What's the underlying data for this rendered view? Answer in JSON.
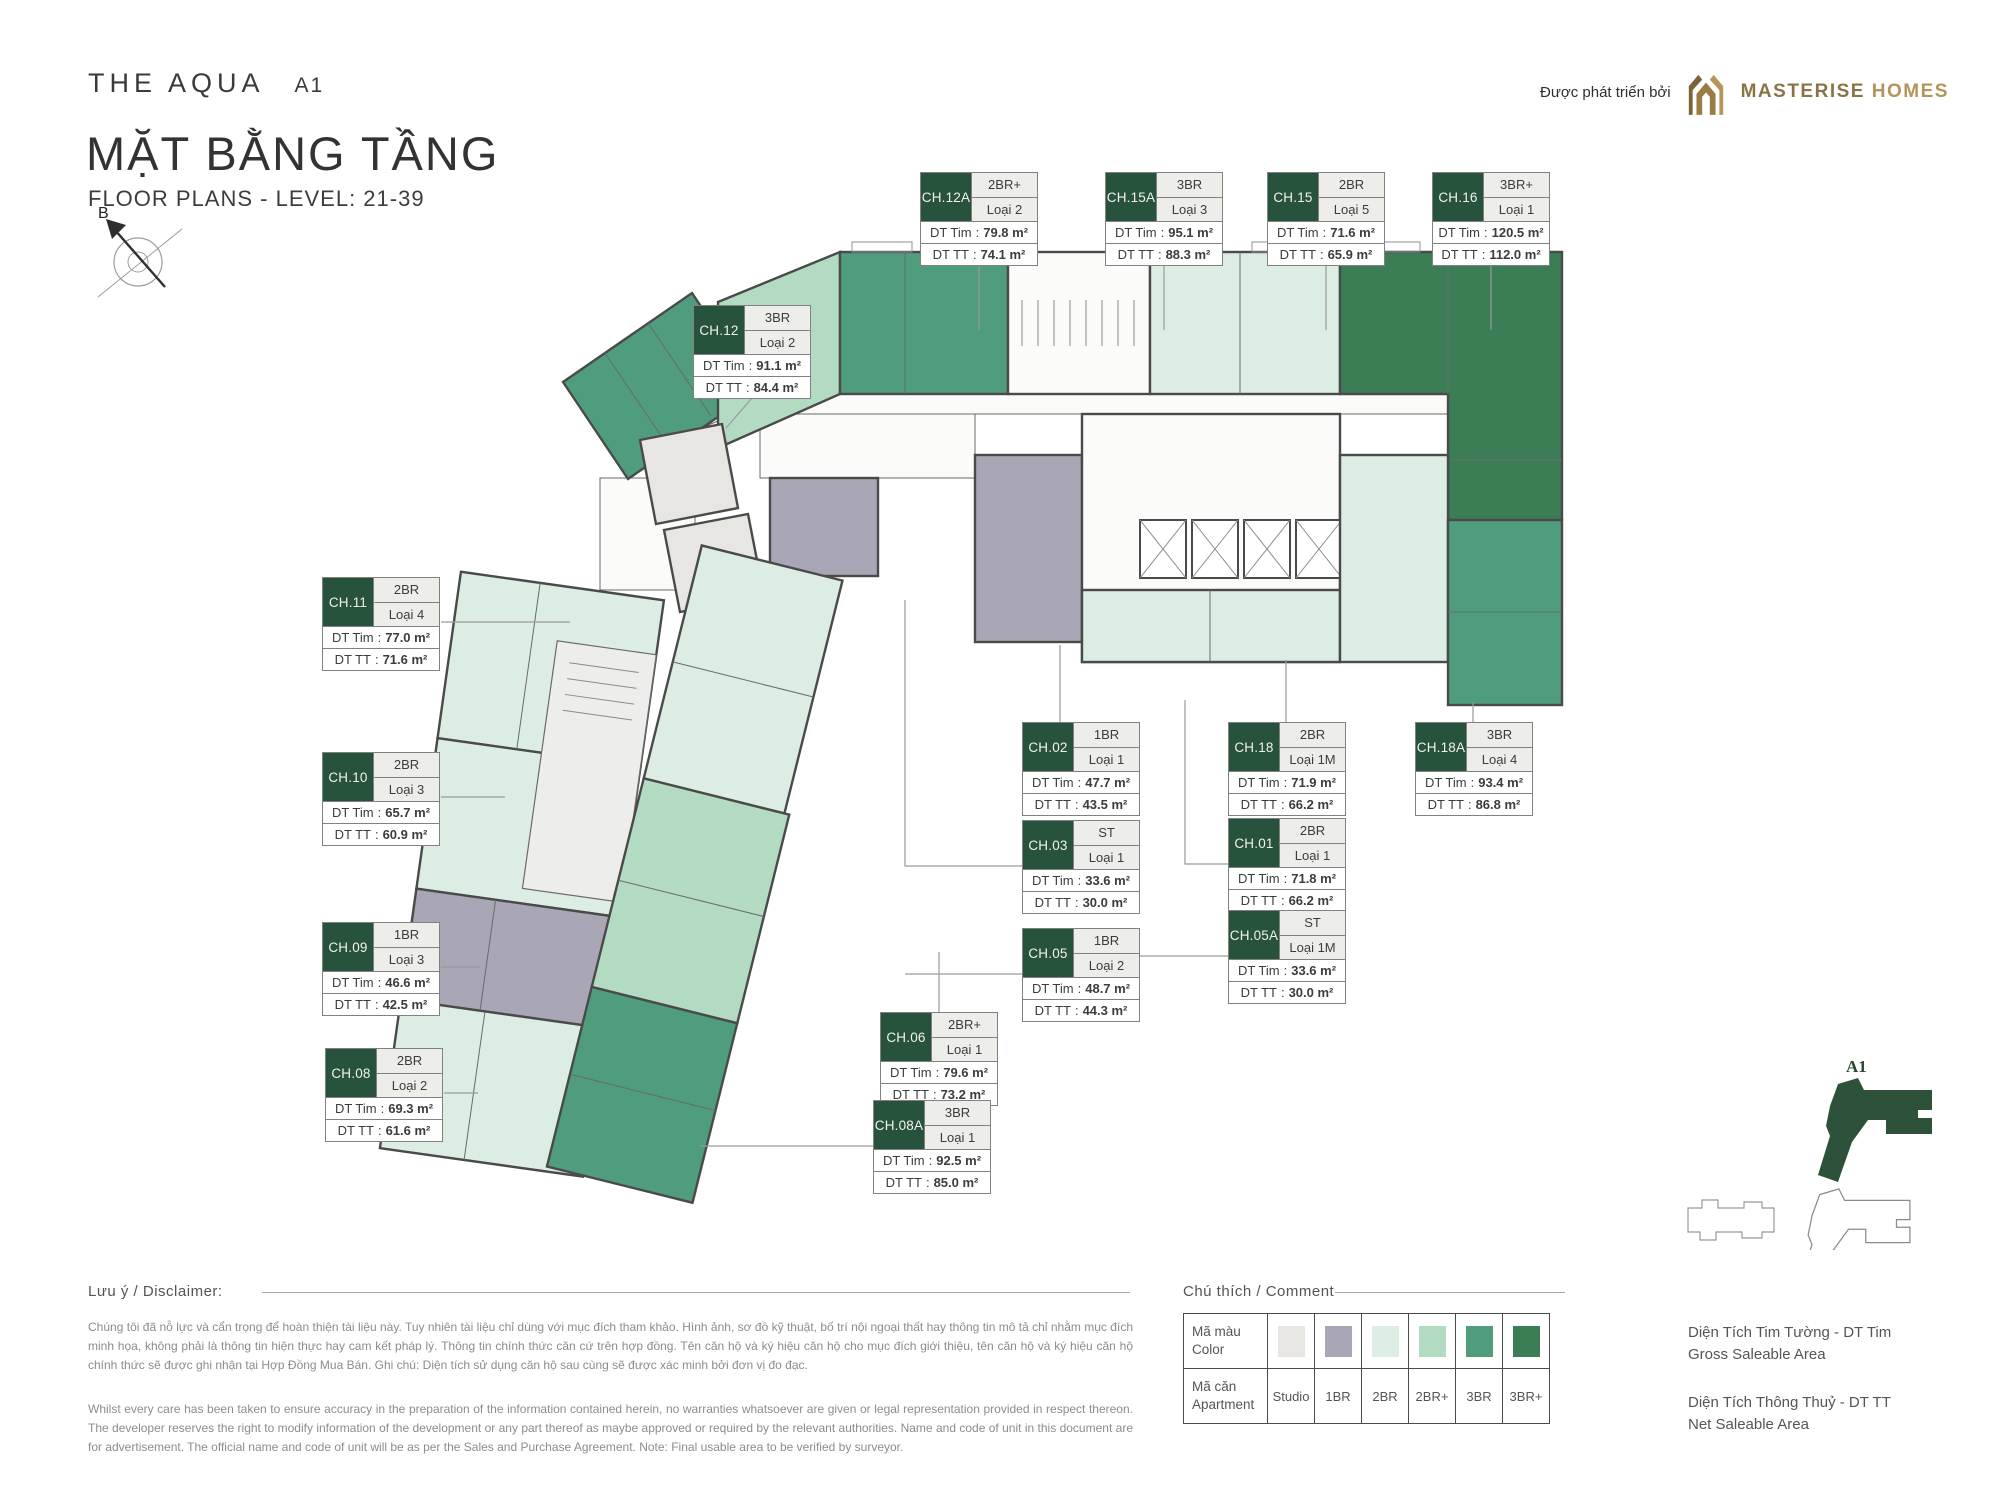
{
  "header": {
    "project": "THE AQUA",
    "tower": "A1",
    "title_vn": "MẶT BẰNG TẦNG",
    "title_en": "FLOOR PLANS - LEVEL: 21-39",
    "developer_prefix": "Được phát triển bởi",
    "developer_name_1": "MASTERISE",
    "developer_name_2": "HOMES",
    "compass_label": "B"
  },
  "labels": {
    "dt_tim": "DT Tim",
    "dt_tt": "DT TT",
    "sep": ":"
  },
  "units": [
    {
      "id": "CH.12A",
      "type": "2BR+",
      "variant": "Loại 2",
      "dt_tim": "79.8 m²",
      "dt_tt": "74.1 m²"
    },
    {
      "id": "CH.15A",
      "type": "3BR",
      "variant": "Loại 3",
      "dt_tim": "95.1 m²",
      "dt_tt": "88.3 m²"
    },
    {
      "id": "CH.15",
      "type": "2BR",
      "variant": "Loại 5",
      "dt_tim": "71.6 m²",
      "dt_tt": "65.9 m²"
    },
    {
      "id": "CH.16",
      "type": "3BR+",
      "variant": "Loại 1",
      "dt_tim": "120.5 m²",
      "dt_tt": "112.0 m²"
    },
    {
      "id": "CH.12",
      "type": "3BR",
      "variant": "Loại 2",
      "dt_tim": "91.1 m²",
      "dt_tt": "84.4 m²"
    },
    {
      "id": "CH.11",
      "type": "2BR",
      "variant": "Loại 4",
      "dt_tim": "77.0 m²",
      "dt_tt": "71.6 m²"
    },
    {
      "id": "CH.10",
      "type": "2BR",
      "variant": "Loại 3",
      "dt_tim": "65.7 m²",
      "dt_tt": "60.9 m²"
    },
    {
      "id": "CH.09",
      "type": "1BR",
      "variant": "Loại 3",
      "dt_tim": "46.6 m²",
      "dt_tt": "42.5 m²"
    },
    {
      "id": "CH.08",
      "type": "2BR",
      "variant": "Loại 2",
      "dt_tim": "69.3 m²",
      "dt_tt": "61.6 m²"
    },
    {
      "id": "CH.02",
      "type": "1BR",
      "variant": "Loại 1",
      "dt_tim": "47.7 m²",
      "dt_tt": "43.5 m²"
    },
    {
      "id": "CH.18",
      "type": "2BR",
      "variant": "Loại 1M",
      "dt_tim": "71.9 m²",
      "dt_tt": "66.2 m²"
    },
    {
      "id": "CH.18A",
      "type": "3BR",
      "variant": "Loại 4",
      "dt_tim": "93.4 m²",
      "dt_tt": "86.8 m²"
    },
    {
      "id": "CH.03",
      "type": "ST",
      "variant": "Loại 1",
      "dt_tim": "33.6 m²",
      "dt_tt": "30.0 m²"
    },
    {
      "id": "CH.01",
      "type": "2BR",
      "variant": "Loại 1",
      "dt_tim": "71.8 m²",
      "dt_tt": "66.2 m²"
    },
    {
      "id": "CH.05A",
      "type": "ST",
      "variant": "Loại 1M",
      "dt_tim": "33.6 m²",
      "dt_tt": "30.0 m²"
    },
    {
      "id": "CH.05",
      "type": "1BR",
      "variant": "Loại 2",
      "dt_tim": "48.7 m²",
      "dt_tt": "44.3 m²"
    },
    {
      "id": "CH.06",
      "type": "2BR+",
      "variant": "Loại 1",
      "dt_tim": "79.6 m²",
      "dt_tt": "73.2 m²"
    },
    {
      "id": "CH.08A",
      "type": "3BR",
      "variant": "Loại 1",
      "dt_tim": "92.5 m²",
      "dt_tt": "85.0 m²"
    }
  ],
  "disclaimer": {
    "heading": "Lưu ý / Disclaimer:",
    "vi": "Chúng tôi đã nỗ lực và cẩn trọng để hoàn thiện tài liệu này. Tuy nhiên tài liệu chỉ dùng với mục đích tham khảo. Hình ảnh, sơ đồ kỹ thuật, bố trí nội ngoại thất hay thông tin mô tả chỉ nhằm mục đích minh họa, không phải là thông tin hiện thực hay cam kết pháp lý. Thông tin chính thức căn cứ trên hợp đồng. Tên căn hộ và ký hiệu căn hộ cho mục đích giới thiệu, tên căn hộ và ký hiệu căn hộ chính thức sẽ được ghi nhận tại Hợp Đồng Mua Bán. Ghi chú: Diện tích sử dụng căn hộ sau cùng sẽ được xác minh bởi đơn vị đo đạc.",
    "en": "Whilst every care has been taken to ensure accuracy in the preparation of the information contained herein, no warranties whatsoever are given or legal representation provided in respect thereon. The developer reserves the right to modify information of the development or any part thereof as maybe approved or required by the relevant authorities. Name and code of unit in this document are for advertisement. The official name and code of unit will be as per the Sales and Purchase Agreement. Note: Final usable area to be verified by surveyor."
  },
  "legend": {
    "heading": "Chú thích / Comment",
    "row_color_vi": "Mã màu",
    "row_color_en": "Color",
    "row_apt_vi": "Mã căn",
    "row_apt_en": "Apartment",
    "types": [
      {
        "label": "Studio",
        "color": "#e7e6e3"
      },
      {
        "label": "1BR",
        "color": "#a9a7b5"
      },
      {
        "label": "2BR",
        "color": "#dcede3"
      },
      {
        "label": "2BR+",
        "color": "#b3dbc2"
      },
      {
        "label": "3BR",
        "color": "#4f9d7c"
      },
      {
        "label": "3BR+",
        "color": "#3b7e56"
      }
    ],
    "notes": [
      {
        "vi": "Diện Tích Tim Tường - DT Tim",
        "en": "Gross Saleable Area"
      },
      {
        "vi": "Diện Tích Thông Thuỷ - DT TT",
        "en": "Net Saleable Area"
      }
    ]
  },
  "minimap": {
    "label": "A1"
  }
}
